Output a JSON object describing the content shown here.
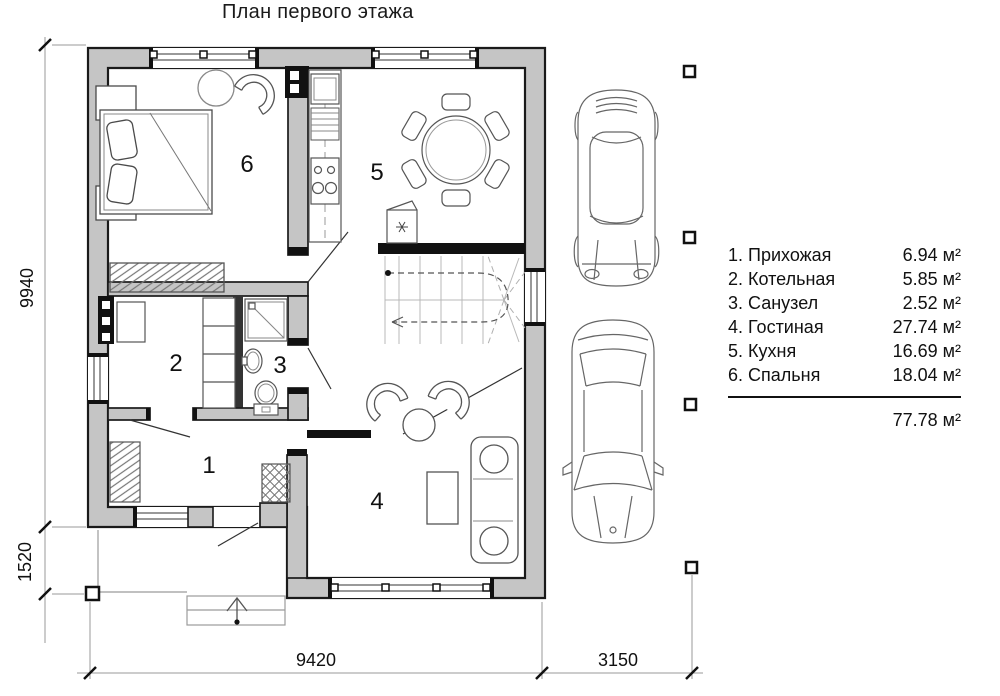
{
  "title": "План первого этажа",
  "legend": {
    "items": [
      {
        "label": "1. Прихожая",
        "area": "6.94 м²"
      },
      {
        "label": "2. Котельная",
        "area": "5.85 м²"
      },
      {
        "label": "3. Санузел",
        "area": "2.52 м²"
      },
      {
        "label": "4. Гостиная",
        "area": "27.74 м²"
      },
      {
        "label": "5. Кухня",
        "area": "16.69 м²"
      },
      {
        "label": "6. Спальня",
        "area": "18.04 м²"
      }
    ],
    "total_area": "77.78 м²"
  },
  "dimensions": {
    "house_height": "9940",
    "porch_height": "1520",
    "house_width": "9420",
    "carport_width": "3150"
  },
  "rooms": {
    "hall": "1",
    "boiler": "2",
    "bathroom": "3",
    "living": "4",
    "kitchen": "5",
    "bedroom": "6"
  },
  "colors": {
    "wall_fill": "#c5c5c5",
    "outline": "#1a1a1a"
  }
}
